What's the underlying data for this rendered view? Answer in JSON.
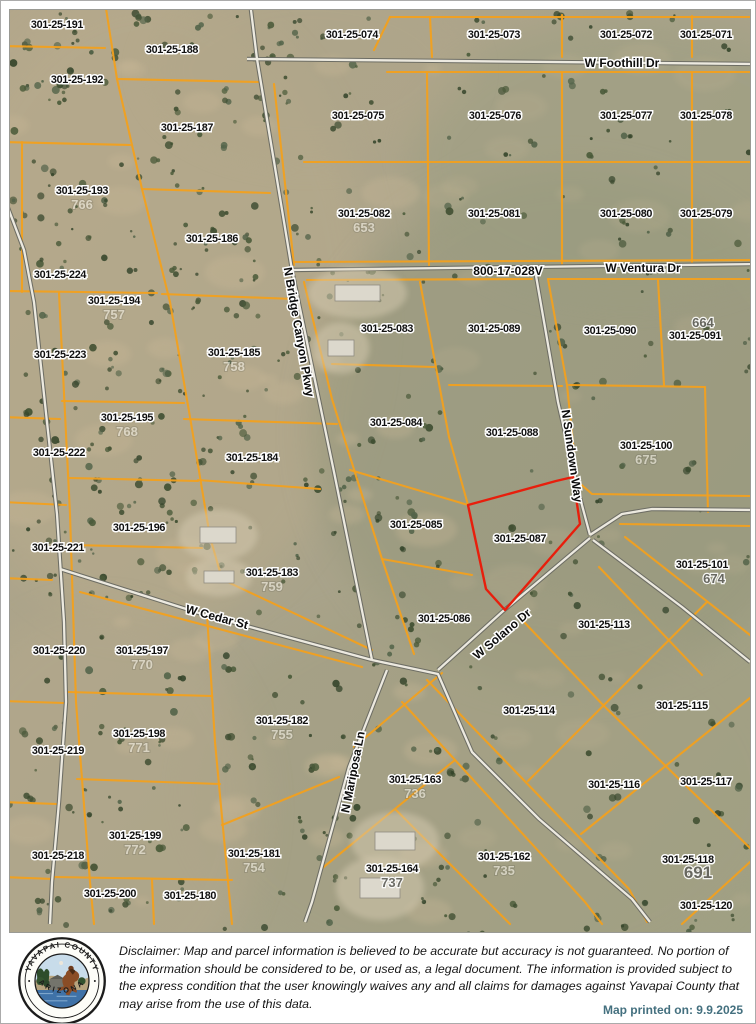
{
  "colors": {
    "parcel_line": "#f2a01e",
    "red_outline": "#e81e0c",
    "road_dark": "#6d6d64",
    "road_light": "#ece9df",
    "label_fill": "#101010",
    "label_halo": "#ffffff",
    "ghost_num": "#f5f2e8",
    "gray_num": "#62625c"
  },
  "map": {
    "red_parcel": "301-25-087",
    "parcels": [
      {
        "id": "301-25-191",
        "x": 47,
        "y": 14
      },
      {
        "id": "301-25-188",
        "x": 162,
        "y": 39
      },
      {
        "id": "301-25-192",
        "x": 67,
        "y": 69
      },
      {
        "id": "301-25-187",
        "x": 177,
        "y": 117
      },
      {
        "id": "301-25-193",
        "x": 72,
        "y": 180,
        "sub": "766"
      },
      {
        "id": "301-25-186",
        "x": 202,
        "y": 228
      },
      {
        "id": "301-25-224",
        "x": 50,
        "y": 264
      },
      {
        "id": "301-25-194",
        "x": 104,
        "y": 290,
        "sub": "757"
      },
      {
        "id": "301-25-223",
        "x": 50,
        "y": 344
      },
      {
        "id": "301-25-185",
        "x": 224,
        "y": 342,
        "sub": "758"
      },
      {
        "id": "301-25-195",
        "x": 117,
        "y": 407,
        "sub": "768"
      },
      {
        "id": "301-25-222",
        "x": 49,
        "y": 442
      },
      {
        "id": "301-25-184",
        "x": 242,
        "y": 447
      },
      {
        "id": "301-25-196",
        "x": 129,
        "y": 517
      },
      {
        "id": "301-25-221",
        "x": 48,
        "y": 537
      },
      {
        "id": "301-25-183",
        "x": 262,
        "y": 562,
        "sub": "759"
      },
      {
        "id": "301-25-220",
        "x": 49,
        "y": 640
      },
      {
        "id": "301-25-197",
        "x": 132,
        "y": 640,
        "sub": "770"
      },
      {
        "id": "301-25-198",
        "x": 129,
        "y": 723,
        "sub": "771"
      },
      {
        "id": "301-25-219",
        "x": 48,
        "y": 740
      },
      {
        "id": "301-25-199",
        "x": 125,
        "y": 825,
        "sub": "772"
      },
      {
        "id": "301-25-218",
        "x": 48,
        "y": 845
      },
      {
        "id": "301-25-200",
        "x": 100,
        "y": 883
      },
      {
        "id": "301-25-180",
        "x": 180,
        "y": 885
      },
      {
        "id": "301-25-181",
        "x": 244,
        "y": 843,
        "sub": "754"
      },
      {
        "id": "301-25-182",
        "x": 272,
        "y": 710,
        "sub": "755"
      },
      {
        "id": "301-25-074",
        "x": 342,
        "y": 24
      },
      {
        "id": "301-25-073",
        "x": 484,
        "y": 24
      },
      {
        "id": "301-25-072",
        "x": 616,
        "y": 24
      },
      {
        "id": "301-25-071",
        "x": 696,
        "y": 24
      },
      {
        "id": "301-25-075",
        "x": 348,
        "y": 105
      },
      {
        "id": "301-25-076",
        "x": 485,
        "y": 105
      },
      {
        "id": "301-25-077",
        "x": 616,
        "y": 105
      },
      {
        "id": "301-25-078",
        "x": 696,
        "y": 105
      },
      {
        "id": "301-25-082",
        "x": 354,
        "y": 203,
        "sub": "653"
      },
      {
        "id": "301-25-081",
        "x": 484,
        "y": 203
      },
      {
        "id": "301-25-080",
        "x": 616,
        "y": 203
      },
      {
        "id": "301-25-079",
        "x": 696,
        "y": 203
      },
      {
        "id": "301-25-083",
        "x": 377,
        "y": 318
      },
      {
        "id": "301-25-089",
        "x": 484,
        "y": 318
      },
      {
        "id": "301-25-090",
        "x": 600,
        "y": 320
      },
      {
        "id": "301-25-091",
        "x": 685,
        "y": 325,
        "sub": "664",
        "sdy": -12,
        "sdx": 8,
        "style": "gray"
      },
      {
        "id": "301-25-084",
        "x": 386,
        "y": 412
      },
      {
        "id": "301-25-088",
        "x": 502,
        "y": 422
      },
      {
        "id": "301-25-100",
        "x": 636,
        "y": 435,
        "sub": "675"
      },
      {
        "id": "301-25-085",
        "x": 406,
        "y": 514
      },
      {
        "id": "301-25-087",
        "x": 510,
        "y": 528
      },
      {
        "id": "301-25-101",
        "x": 692,
        "y": 554,
        "sub": "674",
        "sdx": 12,
        "style": "gray"
      },
      {
        "id": "301-25-086",
        "x": 434,
        "y": 608
      },
      {
        "id": "301-25-113",
        "x": 594,
        "y": 614
      },
      {
        "id": "301-25-114",
        "x": 519,
        "y": 700
      },
      {
        "id": "301-25-115",
        "x": 672,
        "y": 695
      },
      {
        "id": "301-25-116",
        "x": 604,
        "y": 774
      },
      {
        "id": "301-25-117",
        "x": 696,
        "y": 771
      },
      {
        "id": "301-25-118",
        "x": 678,
        "y": 849,
        "sub": "691",
        "sdx": 10,
        "style": "gray-big"
      },
      {
        "id": "301-25-120",
        "x": 696,
        "y": 895
      },
      {
        "id": "301-25-163",
        "x": 405,
        "y": 769,
        "sub": "736"
      },
      {
        "id": "301-25-164",
        "x": 382,
        "y": 858,
        "sub": "737",
        "style": "gray"
      },
      {
        "id": "301-25-162",
        "x": 494,
        "y": 846,
        "sub": "735"
      }
    ],
    "streets": [
      {
        "name": "W Foothill Dr",
        "x": 612,
        "y": 53,
        "rot": 0
      },
      {
        "name": "800-17-028V",
        "x": 498,
        "y": 261,
        "rot": 0
      },
      {
        "name": "W Ventura Dr",
        "x": 633,
        "y": 258,
        "rot": 0
      },
      {
        "name": "N Bridge Canyon Pkwy",
        "x": 289,
        "y": 322,
        "rot": 80
      },
      {
        "name": "N Sundown Way",
        "x": 562,
        "y": 446,
        "rot": 82
      },
      {
        "name": "W Cedar St",
        "x": 207,
        "y": 607,
        "rot": 15
      },
      {
        "name": "W Solano Dr",
        "x": 492,
        "y": 624,
        "rot": -40
      },
      {
        "name": "N Mariposa Ln",
        "x": 343,
        "y": 762,
        "rot": -79
      }
    ],
    "roads": [
      [
        [
          -8,
          182
        ],
        [
          14,
          240
        ],
        [
          24,
          292
        ],
        [
          37,
          412
        ],
        [
          47,
          504
        ],
        [
          54,
          612
        ],
        [
          56,
          692
        ],
        [
          49,
          792
        ],
        [
          42,
          872
        ],
        [
          40,
          914
        ]
      ],
      [
        [
          237,
          49
        ],
        [
          748,
          54
        ]
      ],
      [
        [
          240,
          -8
        ],
        [
          247,
          49
        ],
        [
          282,
          260
        ],
        [
          324,
          462
        ],
        [
          362,
          650
        ]
      ],
      [
        [
          282,
          260
        ],
        [
          748,
          254
        ]
      ],
      [
        [
          525,
          260
        ],
        [
          548,
          392
        ],
        [
          569,
          484
        ],
        [
          580,
          525
        ]
      ],
      [
        [
          580,
          525
        ],
        [
          612,
          504
        ],
        [
          642,
          499
        ],
        [
          748,
          500
        ]
      ],
      [
        [
          583,
          530
        ],
        [
          672,
          597
        ],
        [
          740,
          652
        ]
      ],
      [
        [
          580,
          528
        ],
        [
          492,
          602
        ],
        [
          428,
          660
        ]
      ],
      [
        [
          362,
          650
        ],
        [
          428,
          664
        ],
        [
          462,
          742
        ],
        [
          529,
          809
        ],
        [
          622,
          889
        ],
        [
          640,
          912
        ]
      ],
      [
        [
          50,
          559
        ],
        [
          192,
          604
        ],
        [
          362,
          650
        ]
      ],
      [
        [
          377,
          660
        ],
        [
          339,
          757
        ],
        [
          302,
          892
        ],
        [
          295,
          912
        ]
      ]
    ],
    "parcel_lines": [
      [
        [
          95,
          -8
        ],
        [
          107,
          69
        ],
        [
          132,
          179
        ],
        [
          160,
          292
        ],
        [
          180,
          407
        ],
        [
          200,
          527
        ],
        [
          210,
          562
        ]
      ],
      [
        [
          -8,
          36
        ],
        [
          95,
          38
        ]
      ],
      [
        [
          -8,
          132
        ],
        [
          120,
          135
        ]
      ],
      [
        [
          12,
          132
        ],
        [
          12,
          282
        ]
      ],
      [
        [
          -8,
          281
        ],
        [
          147,
          283
        ]
      ],
      [
        [
          49,
          283
        ],
        [
          60,
          504
        ],
        [
          66,
          692
        ],
        [
          80,
          872
        ],
        [
          84,
          914
        ]
      ],
      [
        [
          -8,
          407
        ],
        [
          50,
          409
        ]
      ],
      [
        [
          -8,
          492
        ],
        [
          56,
          495
        ]
      ],
      [
        [
          -8,
          568
        ],
        [
          42,
          570
        ]
      ],
      [
        [
          -8,
          691
        ],
        [
          54,
          693
        ]
      ],
      [
        [
          -8,
          792
        ],
        [
          47,
          794
        ]
      ],
      [
        [
          -8,
          867
        ],
        [
          44,
          869
        ]
      ],
      [
        [
          52,
          391
        ],
        [
          174,
          393
        ]
      ],
      [
        [
          60,
          468
        ],
        [
          188,
          471
        ]
      ],
      [
        [
          62,
          535
        ],
        [
          192,
          538
        ]
      ],
      [
        [
          188,
          470
        ],
        [
          310,
          479
        ]
      ],
      [
        [
          174,
          409
        ],
        [
          327,
          414
        ]
      ],
      [
        [
          152,
          284
        ],
        [
          284,
          289
        ]
      ],
      [
        [
          132,
          179
        ],
        [
          260,
          183
        ]
      ],
      [
        [
          107,
          69
        ],
        [
          249,
          72
        ]
      ],
      [
        [
          380,
          7
        ],
        [
          364,
          40
        ]
      ],
      [
        [
          380,
          7
        ],
        [
          748,
          7
        ]
      ],
      [
        [
          420,
          7
        ],
        [
          422,
          47
        ]
      ],
      [
        [
          552,
          5
        ],
        [
          552,
          47
        ]
      ],
      [
        [
          682,
          6
        ],
        [
          682,
          47
        ]
      ],
      [
        [
          377,
          62
        ],
        [
          748,
          62
        ]
      ],
      [
        [
          264,
          74
        ],
        [
          284,
          255
        ]
      ],
      [
        [
          294,
          152
        ],
        [
          748,
          152
        ]
      ],
      [
        [
          417,
          62
        ],
        [
          419,
          255
        ]
      ],
      [
        [
          552,
          62
        ],
        [
          552,
          255
        ]
      ],
      [
        [
          682,
          62
        ],
        [
          682,
          255
        ]
      ],
      [
        [
          282,
          252
        ],
        [
          748,
          250
        ]
      ],
      [
        [
          297,
          270
        ],
        [
          522,
          269
        ]
      ],
      [
        [
          538,
          269
        ],
        [
          748,
          269
        ]
      ],
      [
        [
          410,
          272
        ],
        [
          439,
          427
        ],
        [
          458,
          495
        ]
      ],
      [
        [
          439,
          375
        ],
        [
          552,
          376
        ]
      ],
      [
        [
          322,
          354
        ],
        [
          424,
          357
        ]
      ],
      [
        [
          294,
          272
        ],
        [
          322,
          389
        ],
        [
          372,
          549
        ],
        [
          404,
          644
        ]
      ],
      [
        [
          340,
          460
        ],
        [
          458,
          495
        ]
      ],
      [
        [
          372,
          549
        ],
        [
          462,
          565
        ]
      ],
      [
        [
          538,
          269
        ],
        [
          557,
          375
        ],
        [
          566,
          462
        ]
      ],
      [
        [
          559,
          375
        ],
        [
          695,
          377
        ]
      ],
      [
        [
          695,
          377
        ],
        [
          698,
          502
        ]
      ],
      [
        [
          648,
          270
        ],
        [
          654,
          375
        ]
      ],
      [
        [
          566,
          470
        ],
        [
          582,
          484
        ],
        [
          740,
          486
        ]
      ],
      [
        [
          610,
          514
        ],
        [
          740,
          516
        ]
      ],
      [
        [
          615,
          527
        ],
        [
          740,
          625
        ]
      ],
      [
        [
          589,
          557
        ],
        [
          692,
          665
        ]
      ],
      [
        [
          514,
          612
        ],
        [
          594,
          696
        ]
      ],
      [
        [
          518,
          771
        ],
        [
          697,
          592
        ]
      ],
      [
        [
          594,
          696
        ],
        [
          740,
          838
        ]
      ],
      [
        [
          571,
          824
        ],
        [
          740,
          688
        ]
      ],
      [
        [
          672,
          914
        ],
        [
          740,
          852
        ]
      ],
      [
        [
          417,
          670
        ],
        [
          619,
          879
        ],
        [
          637,
          912
        ]
      ],
      [
        [
          392,
          692
        ],
        [
          575,
          892
        ],
        [
          592,
          914
        ]
      ],
      [
        [
          310,
          860
        ],
        [
          445,
          750
        ]
      ],
      [
        [
          386,
          800
        ],
        [
          500,
          914
        ]
      ],
      [
        [
          344,
          737
        ],
        [
          432,
          663
        ]
      ],
      [
        [
          58,
          682
        ],
        [
          202,
          686
        ]
      ],
      [
        [
          67,
          769
        ],
        [
          210,
          774
        ]
      ],
      [
        [
          197,
          604
        ],
        [
          205,
          732
        ],
        [
          222,
          914
        ]
      ],
      [
        [
          212,
          815
        ],
        [
          329,
          767
        ]
      ],
      [
        [
          44,
          867
        ],
        [
          222,
          870
        ]
      ],
      [
        [
          142,
          870
        ],
        [
          144,
          914
        ]
      ],
      [
        [
          70,
          582
        ],
        [
          352,
          657
        ]
      ],
      [
        [
          205,
          566
        ],
        [
          362,
          640
        ]
      ]
    ],
    "red_outline": [
      [
        458,
        495
      ],
      [
        546,
        471
      ],
      [
        563,
        467
      ],
      [
        570,
        514
      ],
      [
        495,
        600
      ],
      [
        476,
        579
      ]
    ],
    "buildings": [
      [
        325,
        275,
        45,
        16
      ],
      [
        318,
        330,
        26,
        16
      ],
      [
        190,
        517,
        36,
        16
      ],
      [
        194,
        561,
        30,
        12
      ],
      [
        365,
        822,
        40,
        18
      ],
      [
        350,
        868,
        40,
        20
      ]
    ]
  },
  "footer": {
    "seal": {
      "top": "YAVAPAI COUNTY",
      "bottom": "ARIZONA"
    },
    "disclaimer": "Disclaimer: Map and parcel information is believed to be accurate but accuracy is not guaranteed. No portion of the information should be considered to be, or used as, a legal document.  The information is provided subject to the express condition that the user knowingly waives any and all claims for damages against Yavapai County that may arise from the use of this data.",
    "printed": "Map printed on: 9.9.2025"
  }
}
